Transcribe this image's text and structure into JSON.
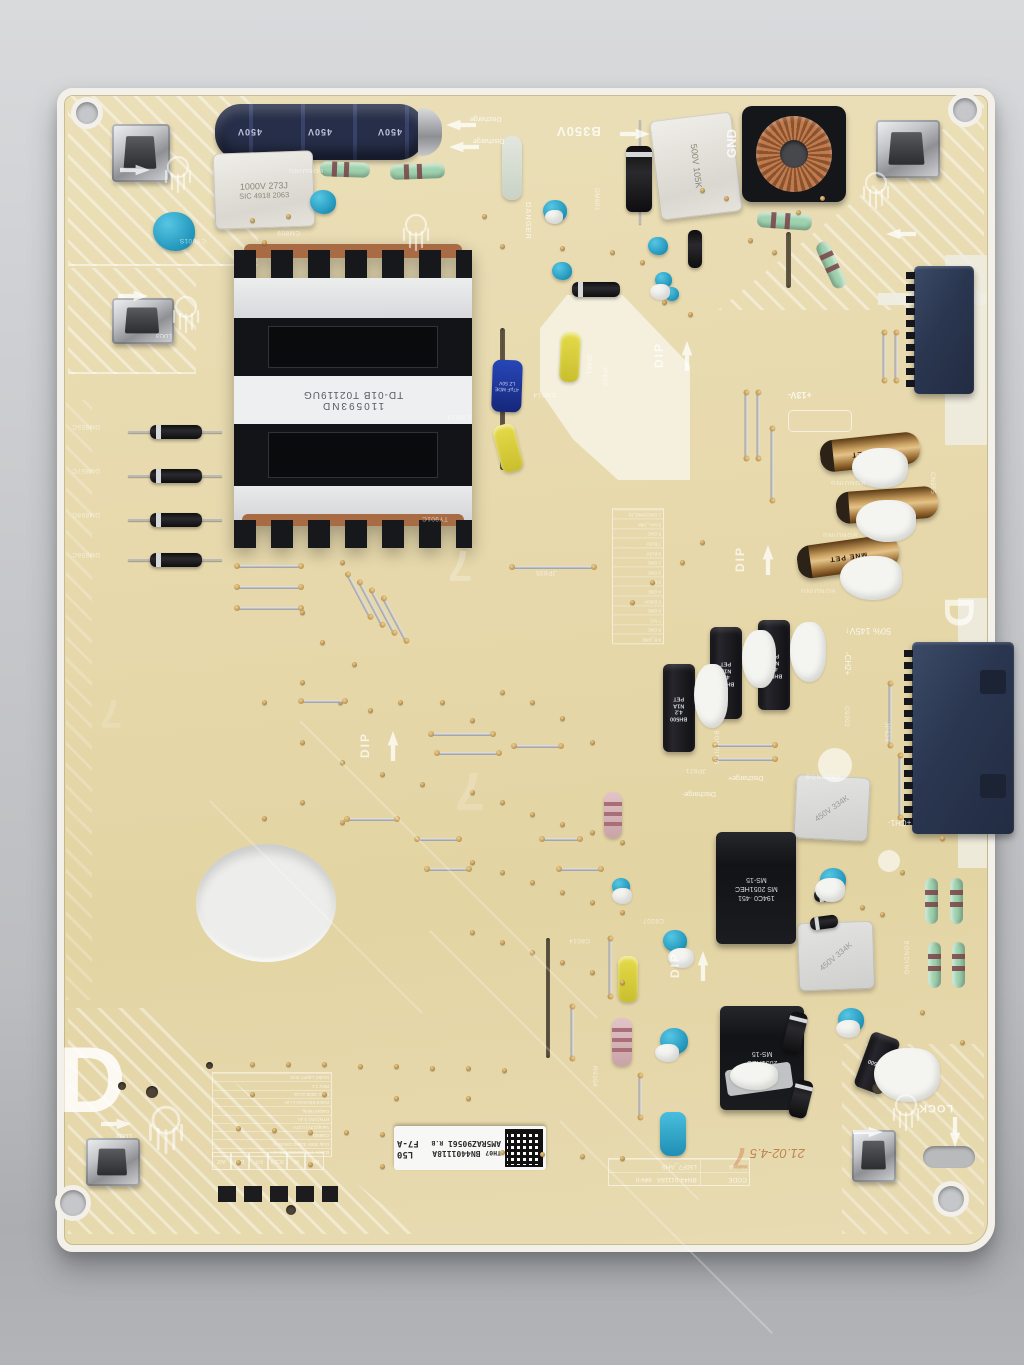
{
  "silkscreen": {
    "b350v": "B350V",
    "gnd": "GND",
    "danger": "DANGER",
    "dip": "DIP",
    "lock": "LOCK",
    "plus13v": "+13V-",
    "rail145": "50% 145V↑",
    "ch2": "-CH2+",
    "ch1": "+CH1-",
    "bonding": "BONDING",
    "discharge_top": "Discharge",
    "discharge_plus": "Discharge+",
    "discharge_minus": "Discharge-",
    "lug2": "LUG2",
    "lug3": "LUG3",
    "corner_letter": "D",
    "edge_letter": "D",
    "watermark": "7",
    "ul_mark": "94V-0",
    "date_code": "21.02-4.5",
    "designators": [
      "DM855C",
      "DM857C",
      "DM858C",
      "DM856C",
      "CY801S",
      "CM809",
      "CM813",
      "CM814",
      "JP851",
      "JP850",
      "JP835",
      "C9207",
      "R9104",
      "TY901C",
      "DM801",
      "CN855",
      "JP821",
      "C9202",
      "JP826",
      "C8014"
    ],
    "pin_table_rows": [
      "9 B_GND",
      "8 GND",
      "7 N.C",
      "6 GND",
      "5 B350V",
      "4 GND",
      "3 N.C",
      "2 GND",
      "1 GND",
      "9 B13V",
      "7 B13V",
      "5 GND",
      "3 AAA_DIM",
      "1 GND(SHIELD)"
    ],
    "spec_rows": [
      "B350V 777 101/201 273H4A",
      "Duty 380V 330Hz Dimming",
      "CN8801",
      "Vamp(13V)  0.37A",
      "RTN(13V)  3.4A",
      "Output rating",
      "Rated Electronics Lim",
      "Date: 2020.12.01",
      "REV 1.1",
      "Model: L50F7 AHS"
    ],
    "box_row": [
      "R/P",
      "VL",
      "3CE1",
      "F/T",
      "1B/I",
      "A/Z"
    ],
    "code_table": [
      [
        "CODE",
        "BN44-01118A"
      ],
      [
        "Model",
        "L50F7_AHS"
      ]
    ]
  },
  "components": {
    "bulk_cap": "450V",
    "film_cap_small": [
      "1000V 273J",
      "SIC 4918 2063"
    ],
    "film_cap_tall": "500V 105K",
    "film_cap_334k": "450V 334K",
    "transformer_sticker": [
      "110593ND",
      "TD-01B T02119UG"
    ],
    "gold_cap": "MNE PET",
    "black_cap": [
      "BH500",
      "4.2",
      "N1A",
      "PET"
    ],
    "blue_cap": [
      "LZ 50V",
      "47µF MDE"
    ],
    "small_transformer": [
      "194C0 ·451",
      "MS 2051HEC",
      "MS-15"
    ],
    "small_transformer2": [
      "2051HEC",
      "MS-15"
    ]
  },
  "sticker": {
    "th": "TH07",
    "code": "BN4401118A",
    "serial": "AM5RAZ90561",
    "rev": "R.B",
    "panel": "L50",
    "version": "F7-A"
  },
  "colors": {
    "board": "#e6d8ab",
    "board_edge": "#f2f0e9",
    "table_bg": "#c7c8cb",
    "connector_navy": "#2e3b55",
    "cap_navy": "#272f4a",
    "copper": "#b57046",
    "mint": "#9fd2ae",
    "teal_disc": "#2caacd",
    "gold": "#c49a5c"
  }
}
